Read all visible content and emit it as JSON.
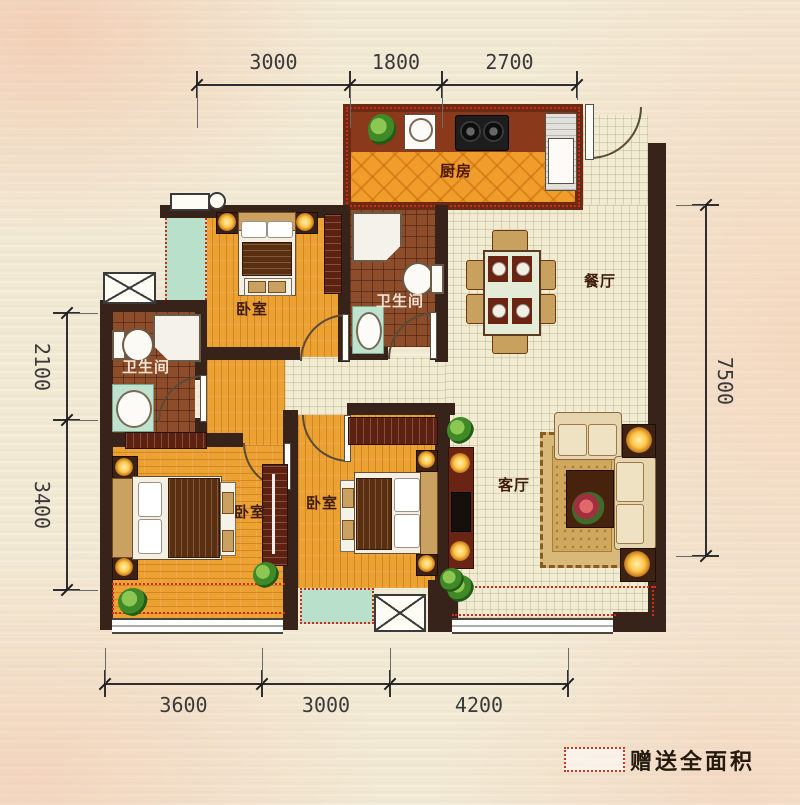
{
  "plan_type": "apartment-floor-plan",
  "palette": {
    "wall": "#38231a",
    "kitchen_wall": "#6a2a13",
    "wood_floor": "#eca133",
    "kitchen_floor": "#f09d2b",
    "bath_tile": "#8d4c2a",
    "hall_tile": "#f1ebd2",
    "bay_teal": "#b9e0cb",
    "gift_dash_red": "#cf2b15",
    "paper": "#f2e9d3"
  },
  "rooms": {
    "kitchen": {
      "label": "厨房"
    },
    "dining": {
      "label": "餐厅"
    },
    "living": {
      "label": "客厅"
    },
    "bedroom_top": {
      "label": "卧室"
    },
    "bedroom_left": {
      "label": "卧室"
    },
    "bedroom_mid": {
      "label": "卧室"
    },
    "bath_mid": {
      "label": "卫生间"
    },
    "bath_left": {
      "label": "卫生间"
    }
  },
  "dimensions_mm": {
    "top": [
      "3000",
      "1800",
      "2700"
    ],
    "bottom": [
      "3600",
      "3000",
      "4200"
    ],
    "left": [
      "2100",
      "3400"
    ],
    "right": [
      "7500"
    ]
  },
  "legend": {
    "gift_label": "赠送全面积"
  }
}
